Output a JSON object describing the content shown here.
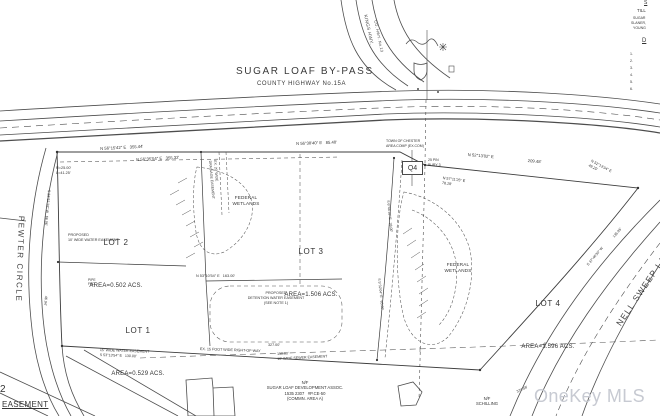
{
  "meta": {
    "watermark": "OneKey MLS"
  },
  "roads": {
    "main": {
      "title": "SUGAR LOAF BY-PASS",
      "subtitle": "COUNTY HIGHWAY No.15A"
    },
    "left": "PEWTER CIRCLE",
    "right": "NELL SWEEP LANE",
    "branch": "KINGS HWY.",
    "branch2": "CO. HWY. No.13"
  },
  "lots": [
    {
      "name": "LOT 1",
      "area": "AREA=0.529 ACS."
    },
    {
      "name": "LOT 2",
      "area": "AREA=0.502 ACS."
    },
    {
      "name": "LOT 3",
      "area": "AREA=1.506 ACS."
    },
    {
      "name": "LOT 4",
      "area": "AREA=1.596 ACS."
    }
  ],
  "wetlands": {
    "label": "FEDERAL\nWETLANDS"
  },
  "marker": {
    "q4": "Q4"
  },
  "corner": {
    "number": "2",
    "easement": "EASEMENT"
  },
  "annotations": [
    {
      "n": "bearing-road-frontage-1",
      "t": "N 56°15'42\" E   355.44'",
      "x": 100,
      "y": 146,
      "s": 4.2,
      "r": -3
    },
    {
      "n": "bearing-road-frontage-2",
      "t": "N 56°38'40\" E   85.40'",
      "x": 296,
      "y": 141,
      "s": 4.2,
      "r": -2
    },
    {
      "n": "bearing-road-frontage-3",
      "t": "N 56°35'54\" E   355.32'",
      "x": 136,
      "y": 157,
      "s": 4.2,
      "r": -3
    },
    {
      "n": "curve-data",
      "t": "R=25.00'\nL=41.25'",
      "x": 56,
      "y": 166,
      "s": 3.8
    },
    {
      "n": "bearing-northeast",
      "t": "N 52°13'02\" E",
      "x": 468,
      "y": 152,
      "s": 4.2,
      "r": 5
    },
    {
      "n": "distance-northeast",
      "t": "209.48'",
      "x": 528,
      "y": 158,
      "s": 4.2,
      "r": 5
    },
    {
      "n": "bearing-corner-ne",
      "t": "N 52°13'34\" E\n49.25'",
      "x": 592,
      "y": 159,
      "s": 3.7,
      "r": 28
    },
    {
      "n": "bearing-q4",
      "t": "N 57°11'25\" E\n78.28'",
      "x": 443,
      "y": 176,
      "s": 3.7,
      "r": 8
    },
    {
      "n": "town-line-note",
      "t": "TOWN OF CHESTER\nAREA COMP (EX.COM)",
      "x": 386,
      "y": 139,
      "s": 3.5
    },
    {
      "n": "pin-note",
      "t": "25 PIN\nBURY 3",
      "x": 428,
      "y": 158,
      "s": 3.5
    },
    {
      "n": "proposed-water-easement-note",
      "t": "PROPOSED\n10' WIDE WATER EASEMENT",
      "x": 68,
      "y": 233,
      "s": 3.7
    },
    {
      "n": "bearing-west-1",
      "t": "S 33°51'18\" W   66.06'",
      "x": 51,
      "y": 190,
      "s": 3.6,
      "r": 95
    },
    {
      "n": "distance-west-2",
      "t": "46.94'",
      "x": 48,
      "y": 296,
      "s": 3.6,
      "r": 95
    },
    {
      "n": "easement-line-bearing",
      "t": "N 53°10'54\" E   163.00'",
      "x": 196,
      "y": 274,
      "s": 3.8
    },
    {
      "n": "detention-easement-note",
      "t": "PROPOSED\nDETENTION WATER EASEMENT\n(SEE NOTE 1)",
      "x": 276,
      "y": 291,
      "s": 3.7,
      "a": "c"
    },
    {
      "n": "drainage-easement-note",
      "t": "EX. 20' WIDE\nDRAINAGE EASEMENT",
      "x": 217,
      "y": 160,
      "s": 3.5,
      "r": 85
    },
    {
      "n": "bearing-divider-1",
      "t": "S 6°46'18\" E   38.00'",
      "x": 390,
      "y": 200,
      "s": 3.5,
      "r": 84
    },
    {
      "n": "bearing-divider-2",
      "t": "S 5°32'04\" E   65.00'",
      "x": 381,
      "y": 278,
      "s": 3.5,
      "r": 84
    },
    {
      "n": "water-easement-bottom-note",
      "t": "15' WIDE WATER EASEMENT\nS 53°13'54\" E   130.00'",
      "x": 100,
      "y": 348,
      "s": 3.6,
      "r": 2
    },
    {
      "n": "right-of-way-note",
      "t": "EX. 15 FOOT WIDE RIGHT-OF-WAY",
      "x": 200,
      "y": 347,
      "s": 3.7,
      "r": 2
    },
    {
      "n": "distance-327",
      "t": "327.00'",
      "x": 268,
      "y": 343,
      "s": 3.7
    },
    {
      "n": "sewer-easement-note",
      "t": "150.00'\n10' WIDE SEWER EASEMENT",
      "x": 277,
      "y": 352,
      "s": 3.6,
      "r": -3
    },
    {
      "n": "nf-sugar-loaf-note",
      "t": "N/F\nSUGAR LOAF DEVELOPMENT ASSOC.\n1535 2307   #P.CE-50\n(COMMN. AREA A)",
      "x": 305,
      "y": 380,
      "s": 4.2,
      "a": "c"
    },
    {
      "n": "nf-schilling-note",
      "t": "N/F\nSCHILLING",
      "x": 487,
      "y": 396,
      "s": 4.2,
      "a": "c"
    },
    {
      "n": "distance-374",
      "t": "374.58'",
      "x": 516,
      "y": 390,
      "s": 3.6,
      "r": -25
    },
    {
      "n": "distance-nell-1",
      "t": "135.95'",
      "x": 612,
      "y": 236,
      "s": 3.6,
      "r": -50
    },
    {
      "n": "bearing-nell",
      "t": "S 37°46'30\" W",
      "x": 586,
      "y": 264,
      "s": 3.6,
      "r": -50
    },
    {
      "n": "pipe-found-note",
      "t": "PIPE\nFND.",
      "x": 88,
      "y": 278,
      "s": 3.3
    },
    {
      "n": "titleblock-heading-1",
      "t": "S",
      "x": 644,
      "y": 0,
      "s": 5,
      "u": 1
    },
    {
      "n": "titleblock-line-1",
      "t": "TILL",
      "x": 637,
      "y": 8,
      "s": 4.4
    },
    {
      "n": "titleblock-line-2",
      "t": "SUGAR",
      "x": 633,
      "y": 16,
      "s": 3.5
    },
    {
      "n": "titleblock-line-3",
      "t": "SLANER,",
      "x": 631,
      "y": 21,
      "s": 3.5
    },
    {
      "n": "titleblock-line-4",
      "t": "YOUNG",
      "x": 633,
      "y": 26,
      "s": 3.5
    },
    {
      "n": "titleblock-heading-2",
      "t": "D",
      "x": 642,
      "y": 38,
      "s": 6,
      "u": 1
    },
    {
      "n": "titleblock-item-1",
      "t": "1.",
      "x": 630,
      "y": 52,
      "s": 3.6
    },
    {
      "n": "titleblock-item-2",
      "t": "2.",
      "x": 630,
      "y": 59,
      "s": 3.6
    },
    {
      "n": "titleblock-item-3",
      "t": "3.",
      "x": 630,
      "y": 66,
      "s": 3.6
    },
    {
      "n": "titleblock-item-4",
      "t": "4.",
      "x": 630,
      "y": 73,
      "s": 3.6
    },
    {
      "n": "titleblock-item-5",
      "t": "5.",
      "x": 630,
      "y": 80,
      "s": 3.6
    },
    {
      "n": "titleblock-item-6",
      "t": "6.",
      "x": 630,
      "y": 87,
      "s": 3.6
    }
  ]
}
